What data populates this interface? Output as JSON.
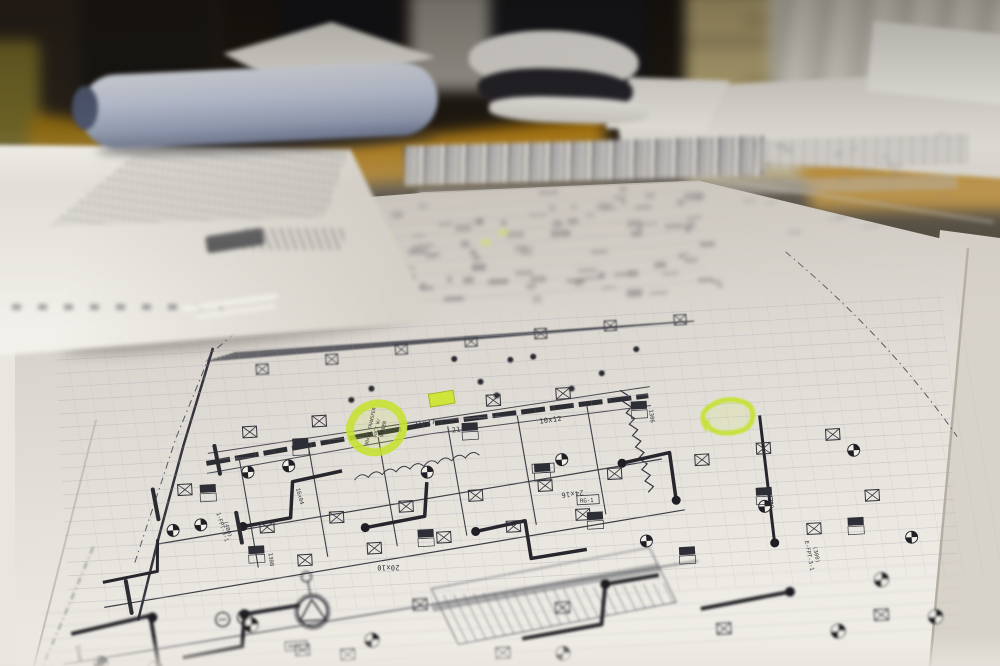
{
  "scene": {
    "description": "Low-angle photograph of mechanical HVAC construction blueprints spread across a wooden conference table; rolled and folded plan sets behind, office chairs, a beige filing cabinet and curtains defocused in the background; two notes circled in green highlighter on the plan",
    "objects": [
      "blueprint-sheet",
      "rolled-plan-set",
      "folded-plan-set",
      "plan-booklet-stack",
      "conference-table",
      "office-chair",
      "filing-cabinet",
      "curtain",
      "highlighter-marks"
    ]
  },
  "palette": {
    "paper": "#ddd9d2",
    "paper_bright": "#efece6",
    "paper_far": "#c9c4bc",
    "ink": "#2e2f35",
    "grid": "#a9a6b8",
    "highlighter": "#c6e230",
    "highlighter_bright": "#d9f545",
    "table_wood": "#a5720e",
    "chair_olive": "#7c6f2c",
    "cabinet_beige": "#b3a473",
    "background_dark": "#14110d",
    "roll_blue_gray": "#b9c1d4"
  },
  "drawing": {
    "highlight_annotation": {
      "line1": "30x14 TRANSFER",
      "line2": "DUCT W/",
      "line3": "SCREEN"
    },
    "dimension_labels": [
      {
        "text": "21x27"
      },
      {
        "text": "10x12"
      },
      {
        "text": "24x16"
      },
      {
        "text": "20x10"
      },
      {
        "text": "16x04"
      },
      {
        "text": "12x08"
      },
      {
        "text": "21x22"
      },
      {
        "text": "1-FPT-3-1"
      },
      {
        "text": "(400)"
      },
      {
        "text": "E-FPT-3-1"
      },
      {
        "text": "(300)"
      }
    ],
    "equipment_tags": [
      {
        "text": "RG-1"
      },
      {
        "text": "MS-1"
      },
      {
        "text": "NG-1"
      },
      {
        "text": "1306"
      },
      {
        "text": "1308"
      },
      {
        "text": "1350"
      }
    ]
  }
}
